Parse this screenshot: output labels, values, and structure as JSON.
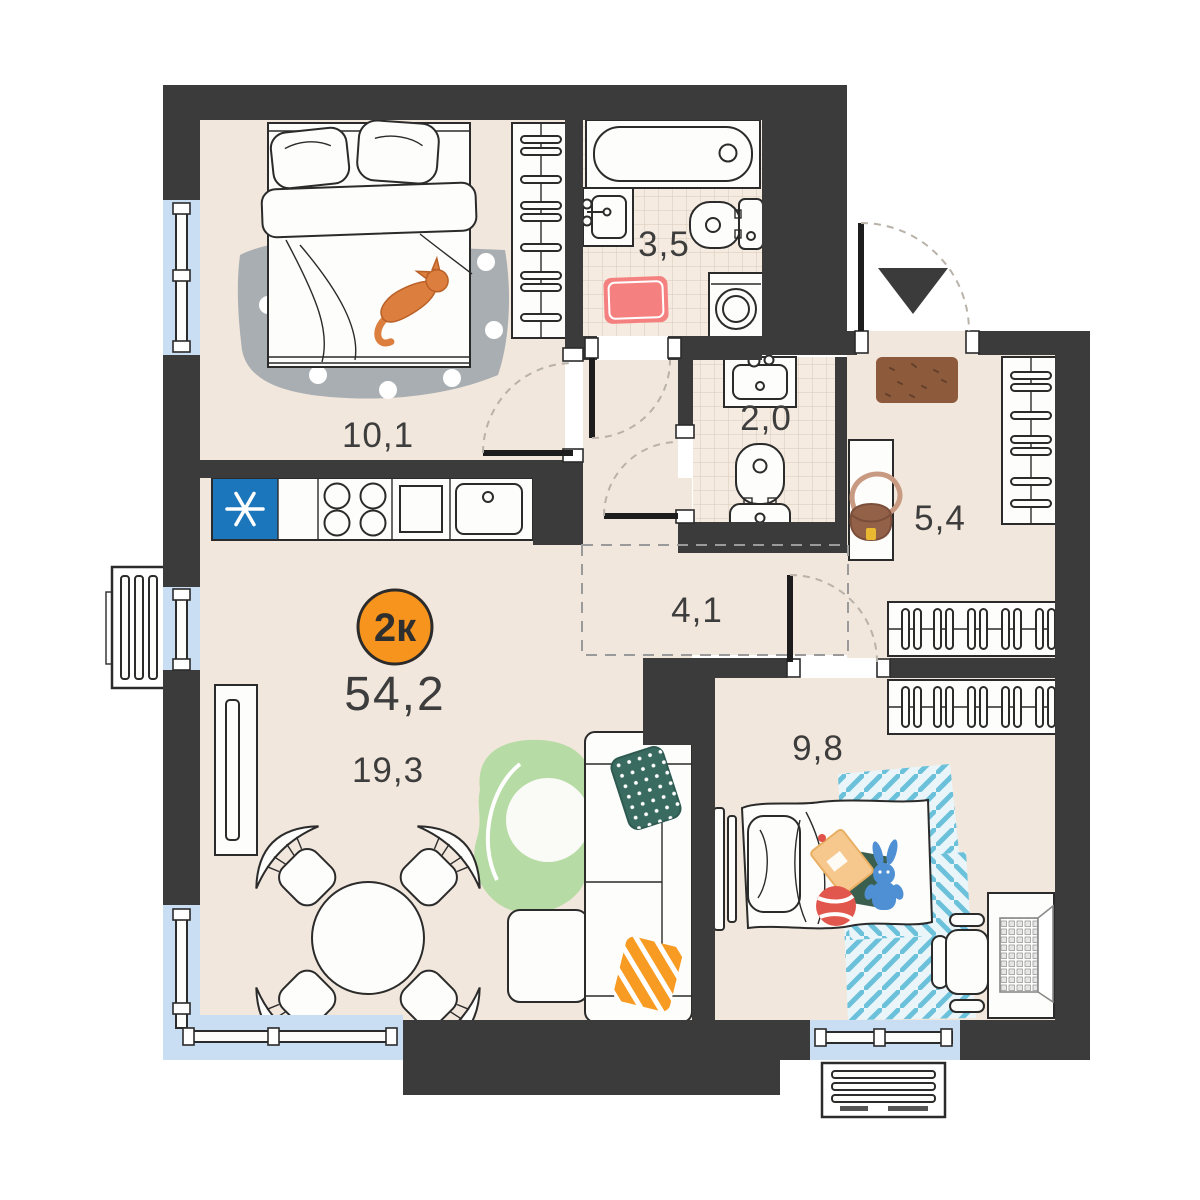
{
  "floorplan": {
    "unit_badge": {
      "label": "2к",
      "color": "#f7941d"
    },
    "total_area": "54,2",
    "rooms": [
      {
        "name": "bedroom",
        "area": "10,1"
      },
      {
        "name": "bathroom",
        "area": "3,5"
      },
      {
        "name": "wc",
        "area": "2,0"
      },
      {
        "name": "hallway",
        "area": "5,4"
      },
      {
        "name": "corridor",
        "area": "4,1"
      },
      {
        "name": "living-kitchen",
        "area": "19,3"
      },
      {
        "name": "kids-room",
        "area": "9,8"
      }
    ],
    "colors": {
      "wall": "#3b3b3b",
      "floor": "#f2e7dc",
      "tile": "#f5ebe0",
      "tile_line": "#ddcfc0",
      "window": "#c9def2",
      "fridge": "#1b76bb",
      "badge": "#f7941d",
      "bath_rug": "#f58080",
      "bedroom_rug": "#a9aeb2",
      "living_rug": "#b7dba5",
      "pillow_green": "#3a6b60",
      "pillow_orange": "#f79b22",
      "kids_rug_stripe": "#6cc1da",
      "doormat": "#8d5a3c",
      "cat": "#dc7e3e",
      "toy_bunny": "#4f90d4",
      "ball": "#e2574d"
    },
    "icons": {
      "entrance_marker": "triangle-down-icon",
      "fridge_symbol": "asterisk-snowflake-icon"
    }
  }
}
